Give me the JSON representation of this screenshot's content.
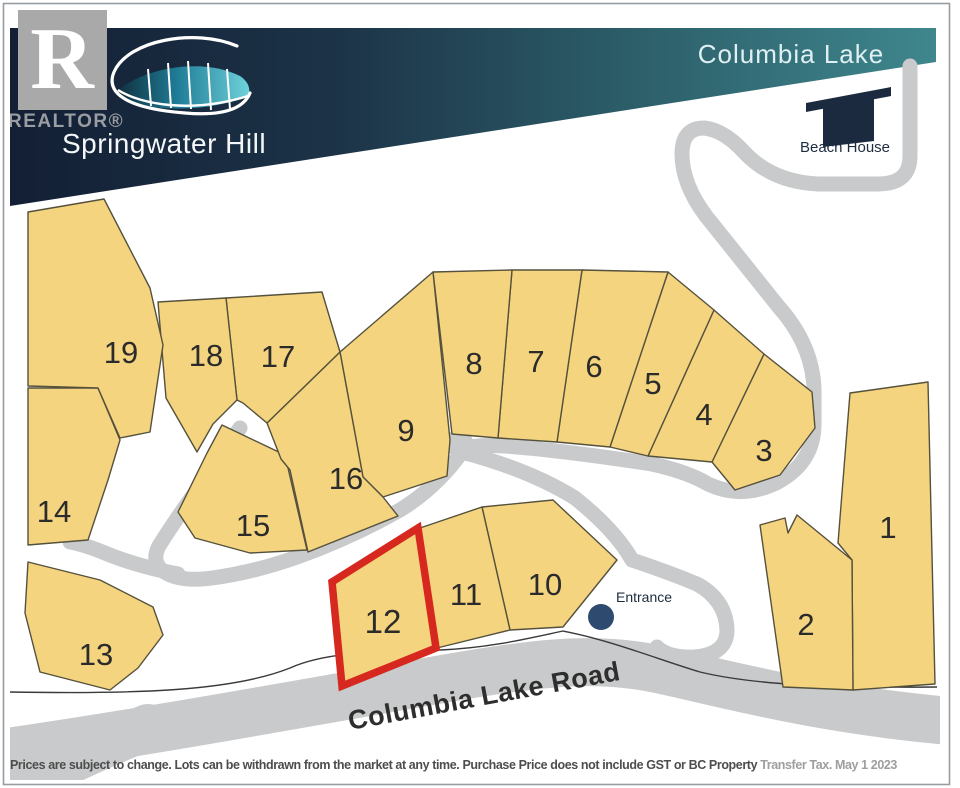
{
  "header": {
    "realtor_mark": "R",
    "realtor_label": "REALTOR®",
    "development_name": "Springwater Hill",
    "lake_label": "Columbia Lake"
  },
  "landmarks": {
    "beach_house_label": "Beach House",
    "entrance_label": "Entrance",
    "road_label": "Columbia Lake Road"
  },
  "highlighted_lot": "12",
  "lots": [
    {
      "id": "1",
      "points": "850,393 928,382 935,684 853,690 852,560 838,543",
      "label": {
        "x": 888,
        "y": 527
      },
      "highlighted": false
    },
    {
      "id": "2",
      "points": "760,525 785,518 788,533 797,515 852,560 853,690 783,687",
      "label": {
        "x": 806,
        "y": 624
      },
      "highlighted": false
    },
    {
      "id": "3",
      "points": "764,354 812,392 815,428 780,475 735,490 712,462",
      "label": {
        "x": 764,
        "y": 450
      },
      "highlighted": false
    },
    {
      "id": "4",
      "points": "714,310 764,354 712,462 648,456",
      "label": {
        "x": 704,
        "y": 414
      },
      "highlighted": false
    },
    {
      "id": "5",
      "points": "668,272 714,310 648,456 610,447",
      "label": {
        "x": 653,
        "y": 383
      },
      "highlighted": false
    },
    {
      "id": "6",
      "points": "582,270 668,272 610,447 557,442",
      "label": {
        "x": 594,
        "y": 366
      },
      "highlighted": false
    },
    {
      "id": "7",
      "points": "512,270 582,270 557,442 498,438",
      "label": {
        "x": 536,
        "y": 361
      },
      "highlighted": false
    },
    {
      "id": "8",
      "points": "433,272 512,270 498,438 452,434",
      "label": {
        "x": 474,
        "y": 363
      },
      "highlighted": false
    },
    {
      "id": "9",
      "points": "433,272 450,440 447,476 383,497 363,477 340,352",
      "label": {
        "x": 406,
        "y": 430
      },
      "highlighted": false
    },
    {
      "id": "10",
      "points": "482,507 553,500 617,560 563,627 510,630",
      "label": {
        "x": 545,
        "y": 584
      },
      "highlighted": false
    },
    {
      "id": "11",
      "points": "420,528 482,507 510,630 437,648",
      "label": {
        "x": 466,
        "y": 594
      },
      "highlighted": false
    },
    {
      "id": "12",
      "points": "418,528 436,648 342,686 332,582",
      "label": {
        "x": 383,
        "y": 622
      },
      "highlighted": true
    },
    {
      "id": "13",
      "points": "28,562 100,580 153,607 163,635 138,668 110,690 40,672 25,613",
      "label": {
        "x": 96,
        "y": 654
      },
      "highlighted": false
    },
    {
      "id": "14",
      "points": "28,388 98,388 120,440 108,480 88,540 28,545",
      "label": {
        "x": 54,
        "y": 511
      },
      "highlighted": false
    },
    {
      "id": "15",
      "points": "222,425 285,455 307,550 250,553 195,538 178,512 207,453",
      "label": {
        "x": 253,
        "y": 525
      },
      "highlighted": false
    },
    {
      "id": "16",
      "points": "267,423 340,352 363,477 383,497 398,516 308,552 290,470 281,459",
      "label": {
        "x": 346,
        "y": 478
      },
      "highlighted": false
    },
    {
      "id": "17",
      "points": "226,298 322,292 340,352 267,423 243,403 237,400",
      "label": {
        "x": 278,
        "y": 356
      },
      "highlighted": false
    },
    {
      "id": "18",
      "points": "158,302 226,298 237,400 213,424 197,452 166,398",
      "label": {
        "x": 206,
        "y": 355
      },
      "highlighted": false
    },
    {
      "id": "19",
      "points": "28,212 104,199 150,288 163,345 150,432 120,438 98,388 28,386",
      "label": {
        "x": 121,
        "y": 352
      },
      "highlighted": false
    }
  ],
  "disclaimer": {
    "main": "Prices are subject to change.  Lots can be withdrawn from the market at any time.  Purchase Price does not include GST or BC Property ",
    "light": "Transfer Tax.  May 1 2023"
  },
  "colors": {
    "lot_fill": "#F4D47E",
    "lot_line": "#55513D",
    "highlight": "#D6281F",
    "road": "#C9CACB",
    "banner_navy": "#131F35",
    "banner_teal": "#3F868D",
    "entrance_dot": "#2E4A6E",
    "icon_navy": "#1B2A3E"
  }
}
